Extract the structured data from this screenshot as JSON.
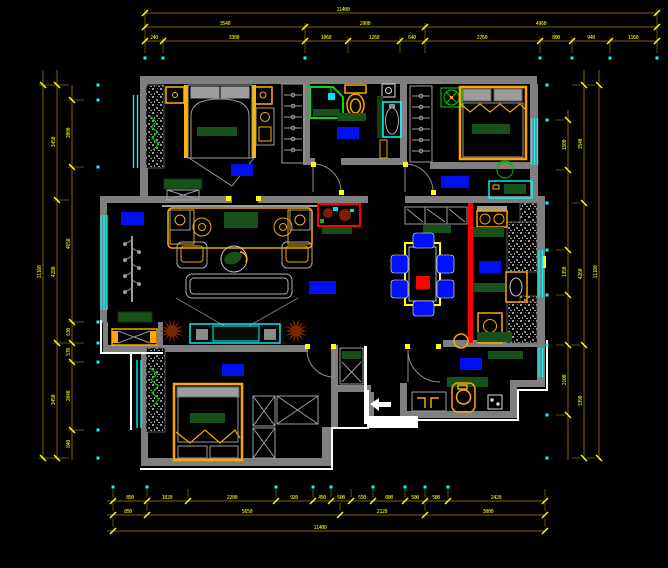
{
  "drawing": {
    "type": "cad-floor-plan",
    "background": "#000000"
  },
  "colors": {
    "wall": "#7f7f7f",
    "dim_line": "#7d6600",
    "dim_text": "#ffff00",
    "window": "#00ffff",
    "label_block": "#0010f0",
    "furniture_orange": "#ffa500",
    "furniture_yellow": "#ffb400",
    "dark_green": "#175018",
    "bright_green": "#00dd00",
    "red": "#ff0000",
    "plant_brown": "#7a2600",
    "white": "#ffffff"
  },
  "dimensions": {
    "rows": [
      {
        "id": "top-1",
        "orient": "h",
        "pos": 13,
        "from": 145,
        "to": 657,
        "extDir": 1,
        "ticks": [
          145,
          657
        ],
        "labels": [
          {
            "at": 343,
            "text": "11400"
          }
        ]
      },
      {
        "id": "top-2",
        "orient": "h",
        "pos": 27,
        "from": 145,
        "to": 657,
        "extDir": 1,
        "ticks": [
          145,
          305,
          425,
          657
        ],
        "labels": [
          {
            "at": 225,
            "text": "3540"
          },
          {
            "at": 365,
            "text": "2900"
          },
          {
            "at": 541,
            "text": "4960"
          }
        ]
      },
      {
        "id": "top-3",
        "orient": "h",
        "pos": 41,
        "from": 145,
        "to": 657,
        "extDir": 1,
        "ticks": [
          145,
          163,
          305,
          348,
          400,
          425,
          540,
          572,
          610,
          657
        ],
        "labels": [
          {
            "at": 154,
            "text": "240"
          },
          {
            "at": 234,
            "text": "3300"
          },
          {
            "at": 326,
            "text": "1060"
          },
          {
            "at": 374,
            "text": "1260"
          },
          {
            "at": 412,
            "text": "640"
          },
          {
            "at": 482,
            "text": "2760"
          },
          {
            "at": 556,
            "text": "800"
          },
          {
            "at": 591,
            "text": "940"
          },
          {
            "at": 633,
            "text": "1160"
          }
        ]
      },
      {
        "id": "bottom-1",
        "orient": "h",
        "pos": 501,
        "from": 107,
        "to": 545,
        "extDir": -1,
        "ticks": [
          113,
          147,
          188,
          276,
          313,
          331,
          351,
          373,
          405,
          425,
          448,
          545
        ],
        "labels": [
          {
            "at": 130,
            "text": "850"
          },
          {
            "at": 167,
            "text": "1020"
          },
          {
            "at": 232,
            "text": "2200"
          },
          {
            "at": 294,
            "text": "920"
          },
          {
            "at": 322,
            "text": "450"
          },
          {
            "at": 341,
            "text": "500"
          },
          {
            "at": 362,
            "text": "550"
          },
          {
            "at": 389,
            "text": "800"
          },
          {
            "at": 415,
            "text": "500"
          },
          {
            "at": 436,
            "text": "580"
          },
          {
            "at": 496,
            "text": "2420"
          }
        ]
      },
      {
        "id": "bottom-2",
        "orient": "h",
        "pos": 515,
        "from": 107,
        "to": 545,
        "extDir": -1,
        "ticks": [
          113,
          147,
          340,
          425,
          545
        ],
        "labels": [
          {
            "at": 128,
            "text": "850"
          },
          {
            "at": 247,
            "text": "5650"
          },
          {
            "at": 382,
            "text": "2120"
          },
          {
            "at": 488,
            "text": "3000"
          }
        ]
      },
      {
        "id": "bottom-3",
        "orient": "h",
        "pos": 531,
        "from": 107,
        "to": 545,
        "extDir": -1,
        "ticks": [
          113,
          545
        ],
        "labels": [
          {
            "at": 320,
            "text": "11400"
          }
        ]
      },
      {
        "id": "left-1",
        "orient": "v",
        "pos": 43,
        "from": 70,
        "to": 460,
        "extDir": 1,
        "ticks": [
          85,
          458
        ],
        "labels": [
          {
            "at": 272,
            "text": "11160"
          }
        ]
      },
      {
        "id": "left-2",
        "orient": "v",
        "pos": 57,
        "from": 70,
        "to": 460,
        "extDir": 1,
        "ticks": [
          85,
          200,
          343,
          458
        ],
        "labels": [
          {
            "at": 142,
            "text": "3450"
          },
          {
            "at": 272,
            "text": "4280"
          },
          {
            "at": 400,
            "text": "3450"
          }
        ]
      },
      {
        "id": "left-3",
        "orient": "v",
        "pos": 72,
        "from": 85,
        "to": 460,
        "extDir": 1,
        "ticks": [
          100,
          167,
          322,
          343,
          362,
          430
        ],
        "labels": [
          {
            "at": 133,
            "text": "2000"
          },
          {
            "at": 244,
            "text": "4650"
          },
          {
            "at": 332,
            "text": "630"
          },
          {
            "at": 352,
            "text": "570"
          },
          {
            "at": 396,
            "text": "2040"
          },
          {
            "at": 444,
            "text": "840"
          }
        ]
      },
      {
        "id": "right-1",
        "orient": "v",
        "pos": 568,
        "from": 110,
        "to": 460,
        "extDir": -1,
        "ticks": [
          120,
          170,
          250,
          295,
          345,
          415
        ],
        "labels": [
          {
            "at": 145,
            "text": "1500"
          },
          {
            "at": 272,
            "text": "1350"
          },
          {
            "at": 380,
            "text": "2100"
          }
        ]
      },
      {
        "id": "right-2",
        "orient": "v",
        "pos": 584,
        "from": 70,
        "to": 460,
        "extDir": -1,
        "ticks": [
          85,
          203,
          345,
          458
        ],
        "labels": [
          {
            "at": 144,
            "text": "3540"
          },
          {
            "at": 274,
            "text": "4260"
          },
          {
            "at": 401,
            "text": "3390"
          }
        ]
      },
      {
        "id": "right-3",
        "orient": "v",
        "pos": 599,
        "from": 70,
        "to": 460,
        "extDir": -1,
        "ticks": [
          85,
          458
        ],
        "labels": [
          {
            "at": 272,
            "text": "11160"
          }
        ]
      }
    ],
    "dots": [
      [
        145,
        58
      ],
      [
        163,
        58
      ],
      [
        305,
        58
      ],
      [
        540,
        58
      ],
      [
        572,
        58
      ],
      [
        610,
        58
      ],
      [
        657,
        58
      ],
      [
        113,
        487
      ],
      [
        147,
        487
      ],
      [
        276,
        487
      ],
      [
        313,
        487
      ],
      [
        331,
        487
      ],
      [
        373,
        487
      ],
      [
        405,
        487
      ],
      [
        425,
        487
      ],
      [
        448,
        487
      ],
      [
        98,
        85
      ],
      [
        98,
        100
      ],
      [
        98,
        167
      ],
      [
        98,
        322
      ],
      [
        98,
        343
      ],
      [
        98,
        362
      ],
      [
        98,
        430
      ],
      [
        98,
        458
      ],
      [
        547,
        85
      ],
      [
        547,
        120
      ],
      [
        547,
        203
      ],
      [
        547,
        250
      ],
      [
        547,
        295
      ],
      [
        547,
        345
      ],
      [
        547,
        415
      ],
      [
        547,
        458
      ]
    ]
  },
  "rooms": [
    {
      "id": "bedroom-1-label",
      "x": 231,
      "y": 164,
      "w": 22,
      "h": 12
    },
    {
      "id": "bathroom-label",
      "x": 337,
      "y": 127,
      "w": 22,
      "h": 12
    },
    {
      "id": "bedroom-2-label",
      "x": 441,
      "y": 176,
      "w": 28,
      "h": 12
    },
    {
      "id": "living-room-label",
      "x": 121,
      "y": 212,
      "w": 23,
      "h": 13
    },
    {
      "id": "hallway-label",
      "x": 309,
      "y": 281,
      "w": 27,
      "h": 13
    },
    {
      "id": "kitchen-label",
      "x": 479,
      "y": 261,
      "w": 22,
      "h": 12
    },
    {
      "id": "bedroom-3-label",
      "x": 222,
      "y": 364,
      "w": 22,
      "h": 12
    },
    {
      "id": "entry-label",
      "x": 460,
      "y": 358,
      "w": 22,
      "h": 12
    }
  ],
  "plants_brown": [
    [
      172,
      331
    ],
    [
      296,
      331
    ]
  ],
  "hinges": [
    [
      311,
      162
    ],
    [
      339,
      190
    ],
    [
      403,
      162
    ],
    [
      431,
      190
    ],
    [
      305,
      344
    ],
    [
      331,
      344
    ],
    [
      405,
      344
    ],
    [
      436,
      344
    ],
    [
      226,
      196
    ],
    [
      256,
      196
    ]
  ]
}
